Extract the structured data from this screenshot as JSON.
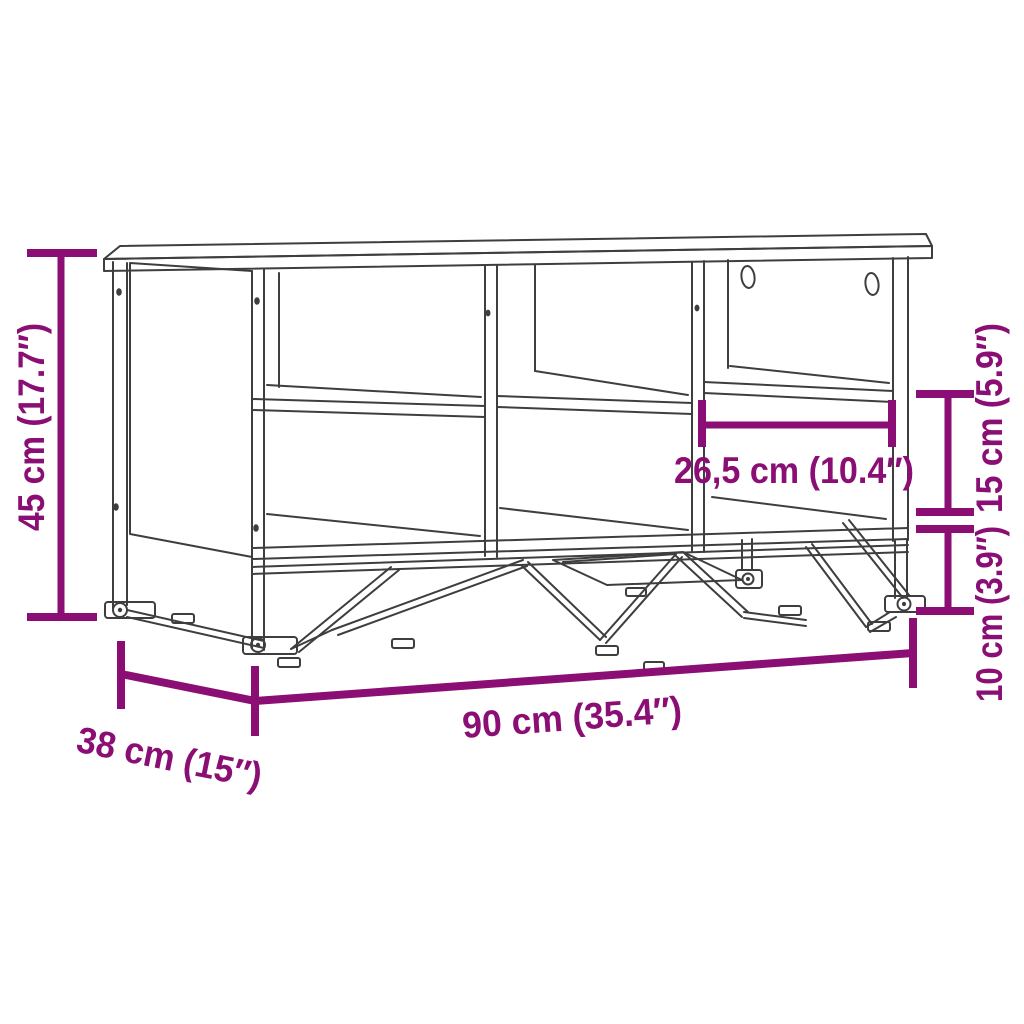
{
  "page": {
    "background": "#ffffff",
    "canvas_size": "1024x1024"
  },
  "diagram": {
    "kind": "product-dimension-line-art",
    "subject": "storage shoe bench with six open compartments, right back panel with two oval cutouts, and angled metal base legs",
    "colors": {
      "line_art": "#3e3e3e",
      "dimension_accent": "#8a0e74"
    },
    "dimensions": {
      "overall_height": {
        "label": "45 cm (17.7″)",
        "position": "left-vertical"
      },
      "overall_width": {
        "label": "90 cm (35.4″)",
        "position": "bottom-diagonal"
      },
      "overall_depth": {
        "label": "38 cm (15″)",
        "position": "bottom-left-diagonal"
      },
      "compartment_width": {
        "label": "26,5 cm (10.4″)",
        "position": "right-compartment-horizontal"
      },
      "opening_height": {
        "label": "15 cm (5.9″)",
        "position": "right-upper-vertical"
      },
      "base_height": {
        "label": "10 cm (3.9″)",
        "position": "right-lower-vertical"
      }
    }
  }
}
